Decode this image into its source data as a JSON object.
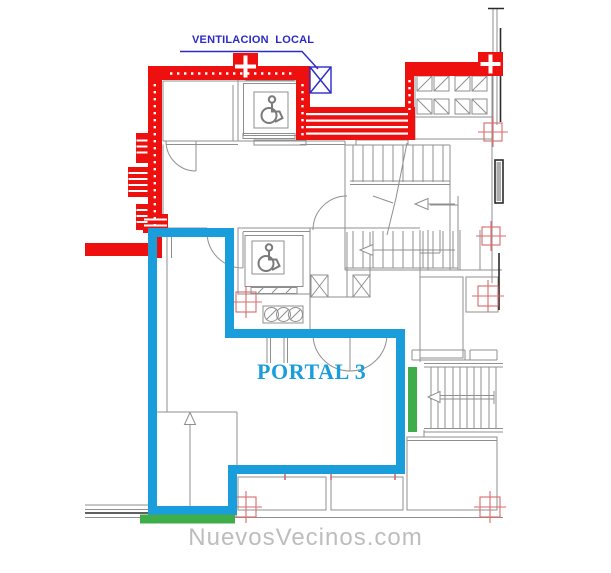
{
  "drawing": {
    "ventilation_label": "VENTILACION  LOCAL",
    "portal_label": "PORTAL 3",
    "watermark": "NuevosVecinos.com"
  },
  "colors": {
    "wall_red": "#ee0f0f",
    "portal_blue": "#1a9edb",
    "annotation_blue": "#2a2ac8",
    "accent_green": "#3fae4a",
    "line_gray": "#8f8f8f",
    "marker_red": "#d96a6a",
    "watermark_gray": "#bdbdbd"
  },
  "icons": {
    "wheelchair_icon": "accessible elevator symbol, 2 instances",
    "ventilation_x_icon": "blue boxed X duct symbol",
    "duct_hatch_icon": "hatched square shaft boxes, 8 instances",
    "grid_marker_icon": "red crosshair survey markers, 6 instances",
    "stair_arrow_icon": "stair direction arrows, 3 instances",
    "ramp_arrow_icon": "up arrow in portal corridor",
    "column_cross_icon": "red column with white cross, 2 instances"
  }
}
